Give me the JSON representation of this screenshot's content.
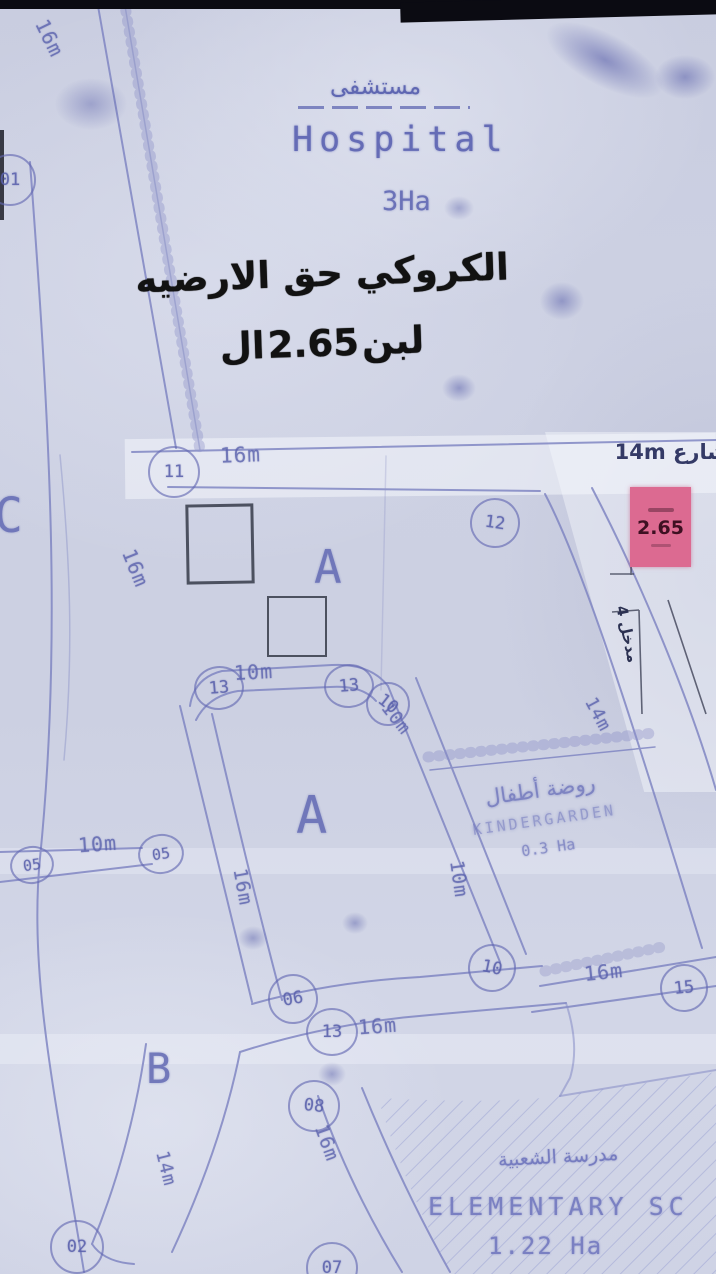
{
  "overlay": {
    "line1": "الكروكي حق الارضيه",
    "line2_left": "ال",
    "line2_num": "2.65",
    "line2_right": "لبن"
  },
  "hospital": {
    "name_ar": "مستشفى",
    "name_en": "Hospital",
    "area": "3Ha"
  },
  "street": {
    "label": "شارع 14m"
  },
  "highlight": {
    "value": "2.65"
  },
  "entrance": {
    "label": "مدخل 4"
  },
  "kindergarten": {
    "name_ar": "روضة أطفال",
    "name_en": "KINDERGARDEN",
    "area": "0.3 Ha"
  },
  "school": {
    "name_ar": "مدرسة الشعبية",
    "name_en": "ELEMENTARY SC",
    "area": "1.22 Ha"
  },
  "blocks": [
    {
      "label": "A"
    },
    {
      "label": "A"
    },
    {
      "label": "B"
    },
    {
      "label": "C"
    }
  ],
  "plots": [
    {
      "label": "01"
    },
    {
      "label": "11"
    },
    {
      "label": "12"
    },
    {
      "label": "13"
    },
    {
      "label": "13"
    },
    {
      "label": "10"
    },
    {
      "label": "05"
    },
    {
      "label": "05"
    },
    {
      "label": "06"
    },
    {
      "label": "10"
    },
    {
      "label": "13"
    },
    {
      "label": "15"
    },
    {
      "label": "08"
    },
    {
      "label": "02"
    },
    {
      "label": "07"
    }
  ],
  "measurements": [
    {
      "label": "16m"
    },
    {
      "label": "16m"
    },
    {
      "label": "16m"
    },
    {
      "label": "10m"
    },
    {
      "label": "10m"
    },
    {
      "label": "14m"
    },
    {
      "label": "10m"
    },
    {
      "label": "10m"
    },
    {
      "label": "16m"
    },
    {
      "label": "16m"
    },
    {
      "label": "16m"
    },
    {
      "label": "16m"
    },
    {
      "label": "14m"
    }
  ],
  "colors": {
    "paper": "#ced2e4",
    "ink_blue": "#7d83c1",
    "ink_dark_blue": "#3a4070",
    "annotation_black": "#141414",
    "highlight_pink": "#dc6a91",
    "pencil_dark": "#3f4358"
  }
}
